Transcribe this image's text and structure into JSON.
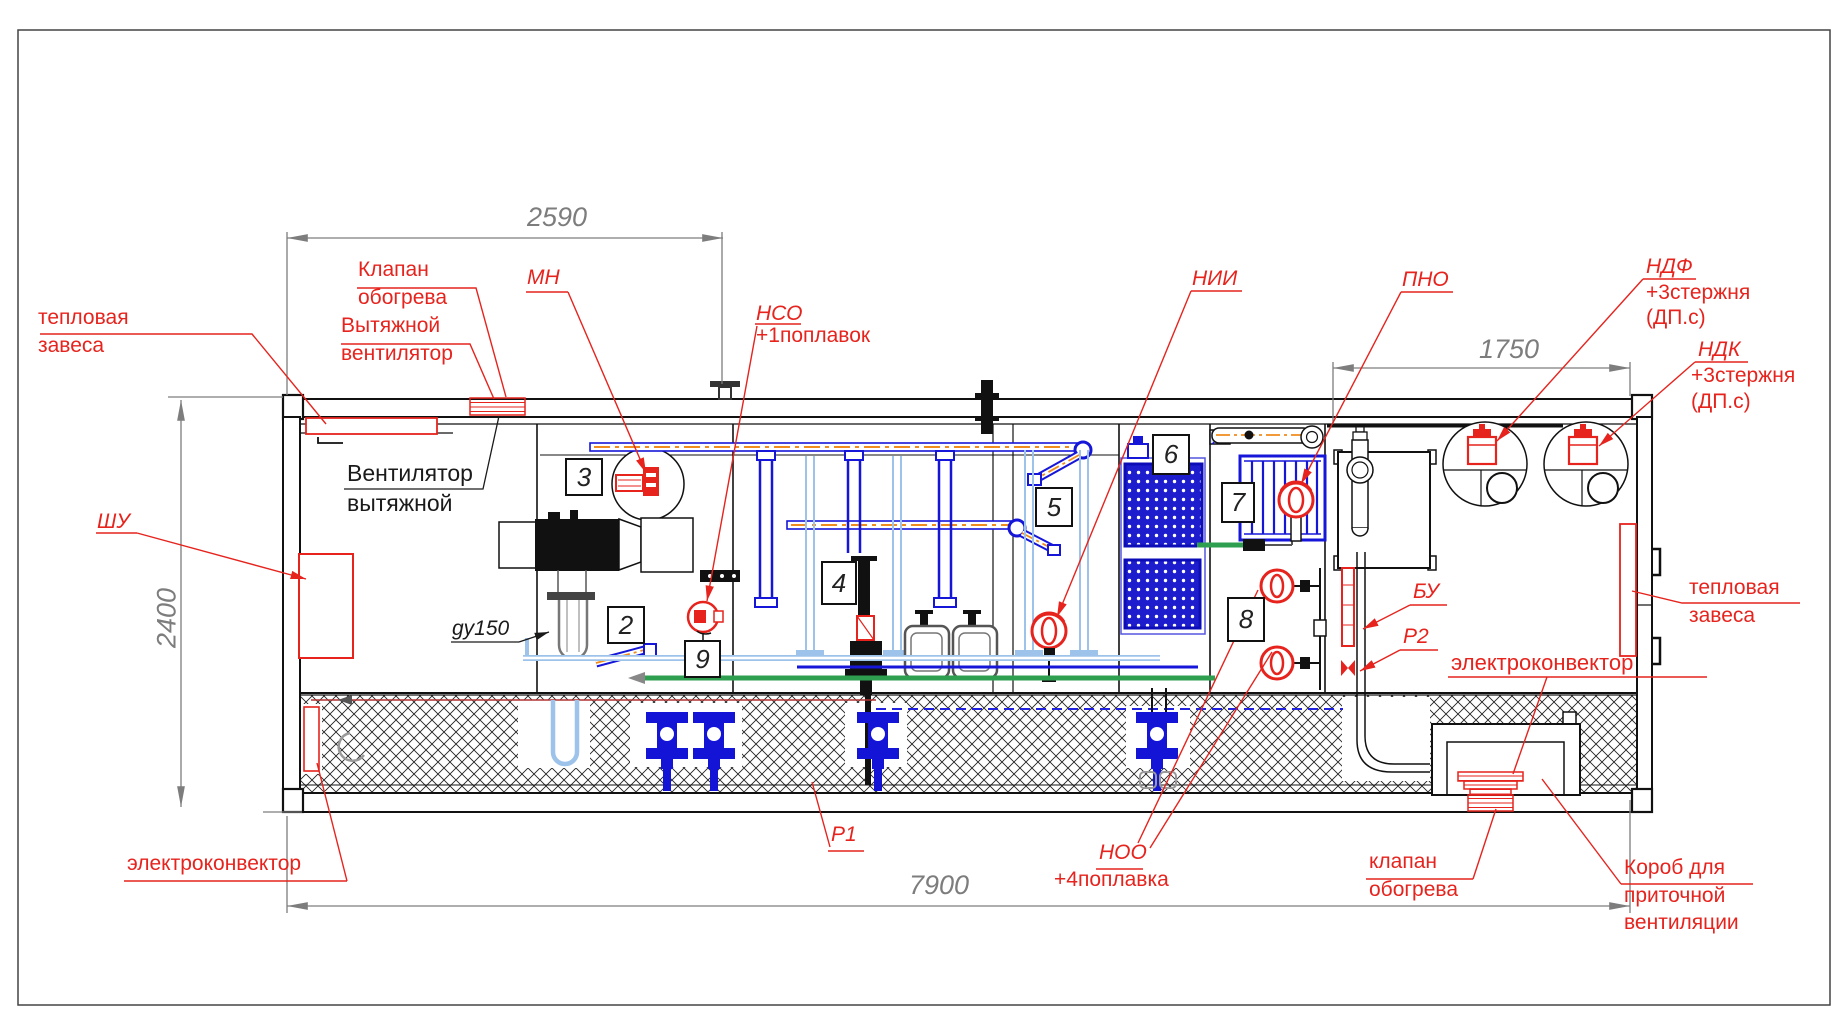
{
  "drawing": {
    "type": "container water treatment plant side elevation",
    "colors": {
      "red": "#e6231d",
      "blue": "#1515d8",
      "light_blue": "#9dc3ea",
      "orange": "#f08c1e",
      "green": "#2e9e4f",
      "dim_gray": "#7d7d7d"
    }
  },
  "dimensions": {
    "top_width": "2590",
    "right_top_width": "1750",
    "left_height": "2400",
    "bottom_width": "7900"
  },
  "markers": [
    "3",
    "2",
    "9",
    "4",
    "5",
    "6",
    "7",
    "8"
  ],
  "labels": {
    "heat_curtain_left_1": "тепловая",
    "heat_curtain_left_2": "завеса",
    "heating_valve_top_1": "Клапан",
    "heating_valve_top_2": "обогрева",
    "exhaust_fan_red_1": "Вытяжной",
    "exhaust_fan_red_2": "вентилятор",
    "exhaust_fan_black_1": "Вентилятор",
    "exhaust_fan_black_2": "вытяжной",
    "mn": "МН",
    "nso": "НСО",
    "nso_note": "+1поплавок",
    "nii": "НИИ",
    "pno": "ПНО",
    "ndf": "НДФ",
    "ndf_note1": "+3стержня",
    "ndf_note2": "(ДП.с)",
    "ndk": "НДК",
    "ndk_note1": "+3стержня",
    "ndk_note2": "(ДП.с)",
    "shu": "ШУ",
    "du150": "gy150",
    "heat_curtain_right_1": "тепловая",
    "heat_curtain_right_2": "завеса",
    "bu": "БУ",
    "r2": "Р2",
    "r1": "Р1",
    "noo": "НОО",
    "noo_note": "+4поплавка",
    "econvector_right": "электроконвектор",
    "econvector_left": "электроконвектор",
    "heating_valve_bottom_1": "клапан",
    "heating_valve_bottom_2": "обогрева",
    "supply_duct_1": "Короб для",
    "supply_duct_2": "приточной",
    "supply_duct_3": "вентиляции"
  }
}
